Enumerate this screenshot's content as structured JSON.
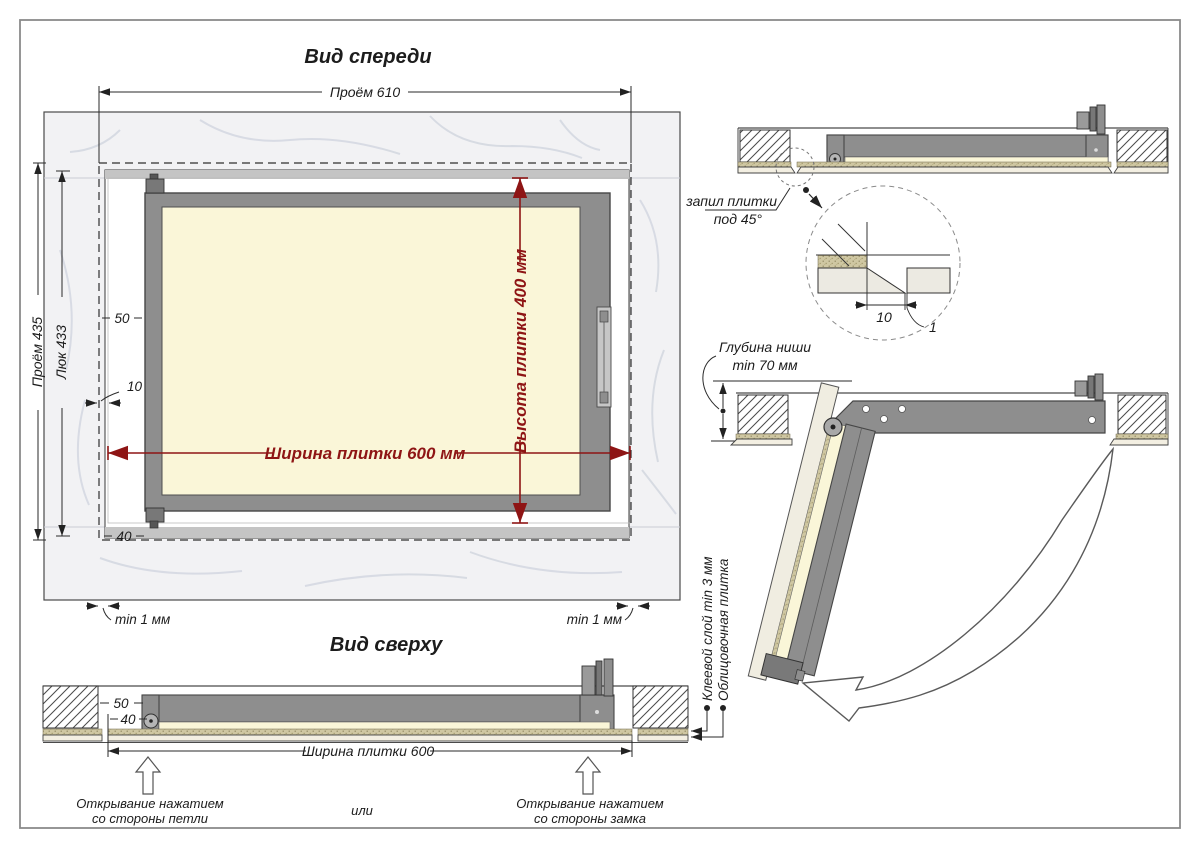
{
  "front_view": {
    "title": "Вид спереди",
    "dim_opening_w": "Проём 610",
    "dim_opening_h": "Проём 435",
    "dim_hatch_h": "Люк 433",
    "dim_frame_offset": "50",
    "dim_tile_offset": "10",
    "dim_bottom_offset": "40",
    "dim_tile_width": "Ширина плитки 600 мм",
    "dim_tile_height": "Высота плитки 400 мм",
    "gap_left": "min 1 мм",
    "gap_right": "min 1 мм"
  },
  "top_view": {
    "title": "Вид сверху",
    "dim_50": "50",
    "dim_40": "40",
    "dim_tile_width": "Ширина плитки 600",
    "open_hinge_line1": "Открывание нажатием",
    "open_hinge_line2": "со стороны петли",
    "or_label": "или",
    "open_lock_line1": "Открывание нажатием",
    "open_lock_line2": "со стороны замка"
  },
  "section_view": {
    "cut_line1": "запил плитки",
    "cut_line2": "под 45°",
    "detail_dim_offset": "10",
    "detail_dim_gap": "1"
  },
  "open_view": {
    "depth_line1": "Глубина ниши",
    "depth_line2": "min 70 мм",
    "label_adhesive": "Клеевой слой min 3 мм",
    "label_tile": "Облицовочная плитка"
  },
  "colors": {
    "dimension_red": "#8e1515",
    "frame_gray": "#8e8e8e",
    "panel_beige": "#faf6d8",
    "adhesive_tan": "#cfc7a2",
    "marble_light": "#f2f2f4"
  }
}
